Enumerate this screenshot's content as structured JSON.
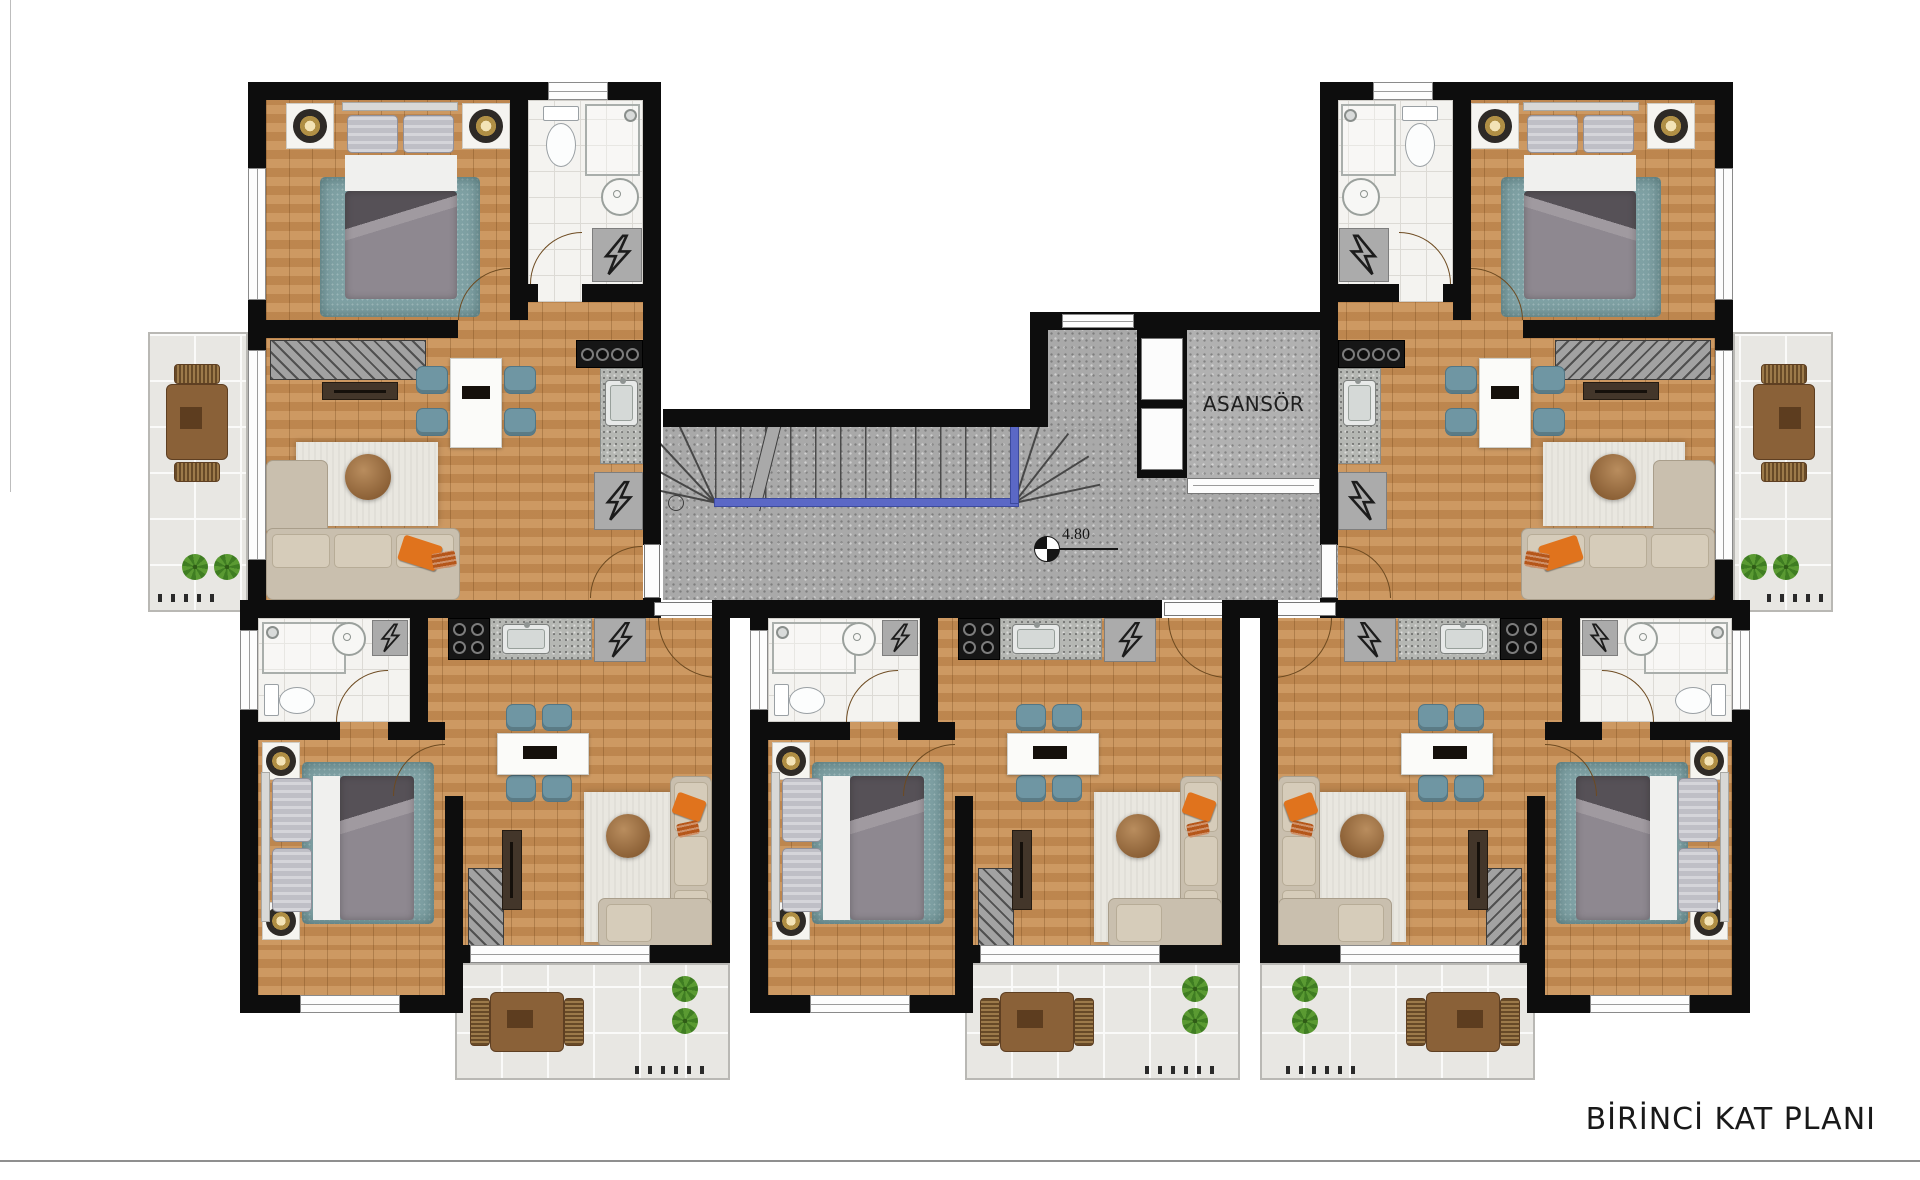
{
  "plan": {
    "title": "BİRİNCİ KAT PLANI",
    "elevator_label": "ASANSÖR",
    "level_marker": "4.80"
  },
  "palette": {
    "wall": "#0d0d0d",
    "wood_floor": "#c68e55",
    "bathroom_tile": "#f4f3f0",
    "balcony_tile": "#e8e7e3",
    "corridor_floor": "#a9a9a9",
    "elevator_shaft": "#b1b1b1",
    "rug_teal": "#7fa1a4",
    "sofa_beige": "#c9bfae",
    "accent_pillow_orange": "#e0731d",
    "dining_chair_teal": "#6f96a3",
    "dining_table_white": "#fbfbf9",
    "stair_rail_blue": "#5b68c6",
    "plant_green": "#3f7d22",
    "balcony_furniture_brown": "#8a6138",
    "title_text": "#191919"
  },
  "shared_areas": [
    "corridor",
    "stairwell",
    "elevator-lobby"
  ],
  "apartments": [
    {
      "id": "top-left",
      "rooms": [
        "bedroom",
        "bathroom",
        "living-dining",
        "kitchenette",
        "balcony"
      ]
    },
    {
      "id": "top-right",
      "rooms": [
        "bedroom",
        "bathroom",
        "living-dining",
        "kitchenette",
        "balcony"
      ]
    },
    {
      "id": "bottom-left",
      "rooms": [
        "bathroom",
        "kitchenette",
        "bedroom",
        "living-dining",
        "balcony"
      ]
    },
    {
      "id": "bottom-middle",
      "rooms": [
        "bathroom",
        "kitchenette",
        "bedroom",
        "living-dining",
        "balcony"
      ]
    },
    {
      "id": "bottom-right",
      "rooms": [
        "bathroom",
        "kitchenette",
        "bedroom",
        "living-dining",
        "balcony"
      ]
    }
  ],
  "icons": {
    "level_marker": "level-marker-icon",
    "electrical_panel": "lightning-bolt-icon",
    "plant": "plant-icon",
    "stairs": "stair-treads",
    "elevator_door": "elevator-door",
    "window": "window-strip",
    "door": "door-arc"
  }
}
